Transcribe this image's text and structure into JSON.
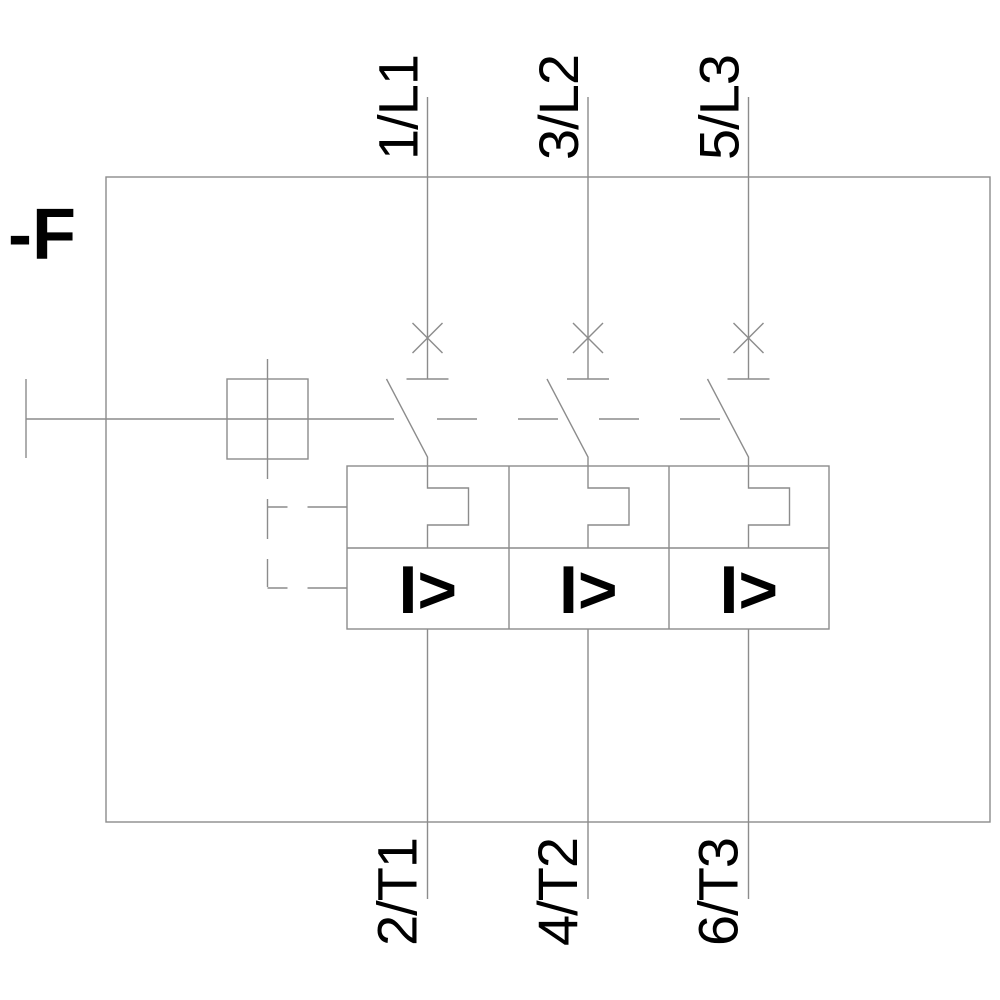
{
  "diagram": {
    "device_tag": "-F",
    "symbol": "motor-protection-circuit-breaker-3-pole",
    "poles": [
      {
        "top_terminal": "1/L1",
        "bottom_terminal": "2/T1",
        "overcurrent_label": "I>"
      },
      {
        "top_terminal": "3/L2",
        "bottom_terminal": "4/T2",
        "overcurrent_label": "I>"
      },
      {
        "top_terminal": "5/L3",
        "bottom_terminal": "6/T3",
        "overcurrent_label": "I>"
      }
    ],
    "colors": {
      "line": "#8c8c8c",
      "text": "#000000",
      "background": "#ffffff"
    }
  }
}
